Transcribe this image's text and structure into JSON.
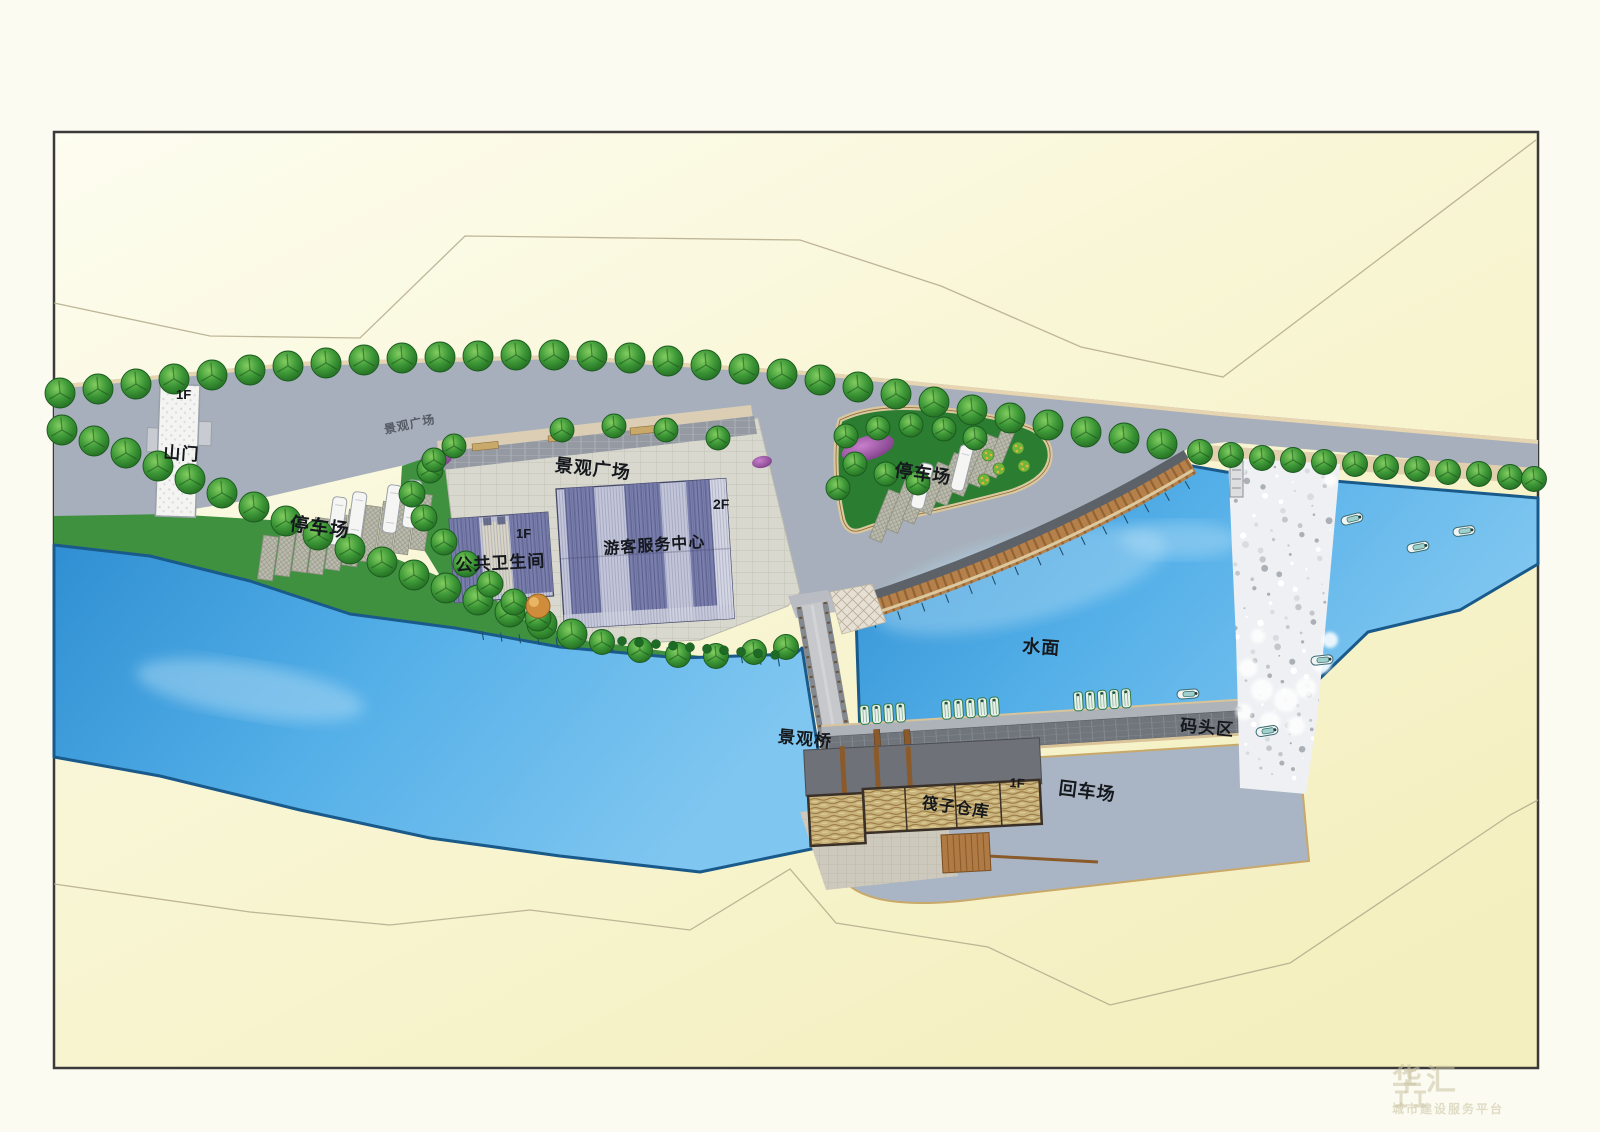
{
  "site": {
    "gate": {
      "name": "山门",
      "floor": "1F"
    },
    "parking_west": {
      "name": "停车场"
    },
    "road_plaza_note": {
      "name": "景观广场"
    },
    "plaza": {
      "name": "景观广场"
    },
    "restroom": {
      "name": "公共卫生间",
      "floor": "1F"
    },
    "visitor_center": {
      "name": "游客服务中心",
      "floor": "2F"
    },
    "parking_north": {
      "name": "停车场"
    },
    "water": {
      "name": "水面"
    },
    "bridge": {
      "name": "景观桥"
    },
    "dock": {
      "name": "码头区"
    },
    "turnaround": {
      "name": "回车场"
    },
    "warehouse": {
      "name": "筏子仓库",
      "floor": "1F"
    }
  },
  "watermark": {
    "title": "华汇",
    "subtitle": "城市建设服务平台"
  },
  "colors": {
    "land": "#f9f6d6",
    "land_light": "#fdfdf0",
    "road": "#a6afbb",
    "water": "#4aa5e2",
    "water_light": "#7fc6f0",
    "water_edge": "#1a5a8a",
    "green_bank": "#3f9140",
    "island_green": "#2a7d31",
    "tree": "#2f8f35",
    "plaza": "#d8d8cf",
    "walkway_dark": "#959aa2",
    "sidewalk_tan": "#ddd0b4",
    "roof_light": "#c3c6da",
    "roof_dark": "#7a7fae",
    "boardwalk": "#b5804a",
    "dock_brick": "#70757c",
    "slab": "#a9b5c4",
    "apron": "#cdc9bc",
    "straw": "#c8b47c",
    "wood": "#8a5a2a",
    "stall": "#cfc39b",
    "shrub_purple": "#a04fa8",
    "rapids": "#eef0f3",
    "contour": "#b3a98b",
    "frame": "#3a3a3a",
    "gate_fill": "#f4f4f2",
    "bus": "#f5f5f4",
    "tan_edge": "#e2cfae",
    "watermark": "#c8c2a2"
  }
}
